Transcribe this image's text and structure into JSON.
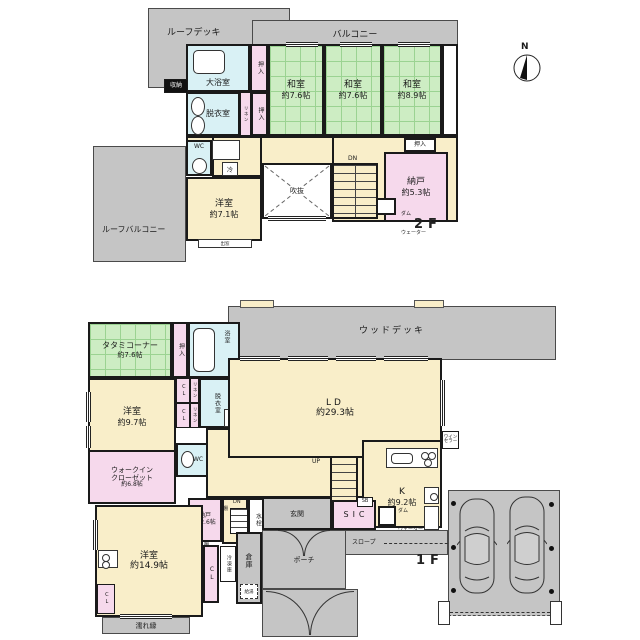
{
  "compass": {
    "north": "N"
  },
  "floor2": {
    "floor_label": "2F",
    "roof_deck": "ルーフデッキ",
    "balcony": "バルコニー",
    "large_bath": "大浴室",
    "storage": "収納",
    "oshiire": "押入",
    "linen": "リネン",
    "dressing": "脱衣室",
    "washitsu_a": {
      "name": "和室",
      "size": "約7.6帖"
    },
    "washitsu_b": {
      "name": "和室",
      "size": "約7.6帖"
    },
    "washitsu_c": {
      "name": "和室",
      "size": "約8.9帖"
    },
    "wc": "WC",
    "fridge": "冷",
    "hall_oshiire": "押入",
    "void": "吹抜",
    "stairs_down": "DN",
    "nando": {
      "name": "納戸",
      "size": "約5.3帖"
    },
    "dumbwaiter": {
      "line1": "ダム",
      "line2": "ウェーター"
    },
    "youshitsu": {
      "name": "洋室",
      "size": "約7.1帖"
    },
    "bay_window": "出窓",
    "roof_balcony": "ルーフバルコニー"
  },
  "floor1": {
    "floor_label": "1F",
    "wood_deck": "ウッドデッキ",
    "tatami_corner": {
      "name": "タタミコーナー",
      "size": "約7.6帖"
    },
    "oshiire": "押入",
    "bath": "浴室",
    "dressing": "脱衣室",
    "washer": "洗",
    "linen": "リネン",
    "cl": "CL",
    "wc": "WC",
    "youshitsu_a": {
      "name": "洋室",
      "size": "約9.7帖"
    },
    "walkin": {
      "line1": "ウォークイン",
      "line2": "クローゼット",
      "size": "約6.8帖"
    },
    "nando": {
      "name": "納戸",
      "size": "約2.6帖"
    },
    "shelf": "棚",
    "stairs_up": "UP",
    "stairs_down": "DN",
    "faucet": "水栓",
    "freezer": "冷凍庫",
    "warehouse": "倉庫",
    "water_heater": "給湯",
    "youshitsu_b": {
      "name": "洋室",
      "size": "約14.9帖"
    },
    "nureen": "濡れ縁",
    "ld": {
      "name": "LD",
      "size": "約29.3帖"
    },
    "kitchen": {
      "name": "K",
      "size": "約9.2帖"
    },
    "wine_cellar": {
      "line1": "ワイン",
      "line2": "セラー"
    },
    "dumbwaiter": {
      "line1": "ダム",
      "line2": "ウェーター"
    },
    "genkan": "玄関",
    "sic": "SIC",
    "sb": "SB",
    "slope": "スロープ",
    "porch": "ポーチ"
  }
}
